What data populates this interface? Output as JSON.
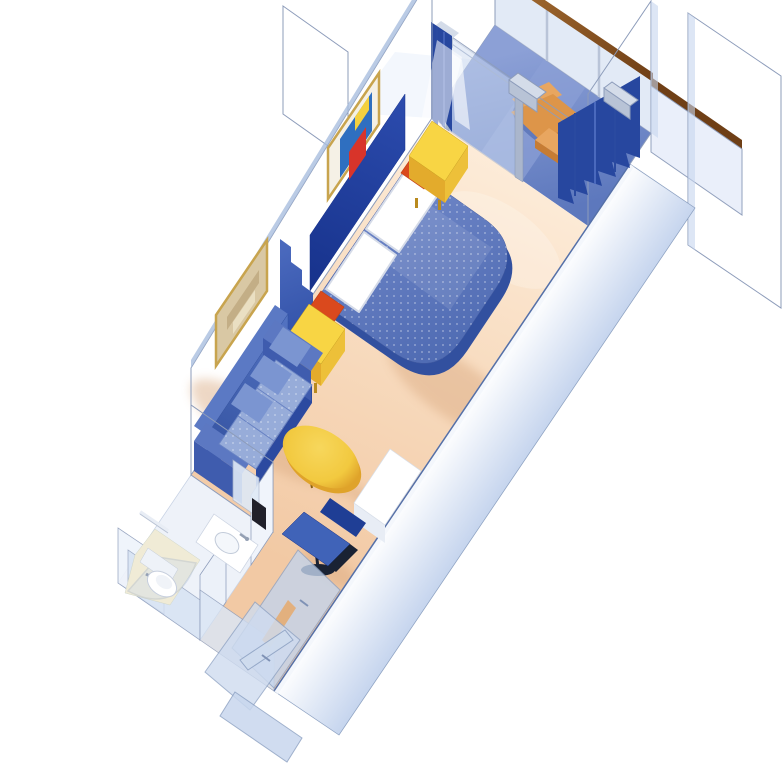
{
  "figure": {
    "kind": "isometric-cutaway-floor-plan",
    "subject": "cruise-ship-stateroom-with-private-balcony",
    "background": "#ffffff"
  },
  "palette": {
    "white": "#ffffff",
    "floor_light": "#fdecd9",
    "floor": "#f8dcc0",
    "floor_deep": "#f2c9a4",
    "floor_shadow": "#d9a87f",
    "bath_floor": "#eef2f9",
    "balcony_floor": "#5d78bd",
    "balcony_light": "#8ca0d6",
    "wall_light": "#e9effa",
    "wall_mid": "#c6d5ee",
    "wall_deep": "#a9bede",
    "edge": "#8d9cba",
    "edge_soft": "#aab6cc",
    "edge_dark": "#5570a8",
    "glass": "#ccdaf0",
    "wood": "#6f3f16",
    "wood_light": "#a86f33",
    "bed_hi": "#7289c9",
    "bed_mid": "#4e6ab2",
    "bed_dark": "#32509f",
    "headboard_hi": "#2c4cae",
    "headboard": "#16318a",
    "pillow": "#ffffff",
    "pillow_shade": "#d5dbe8",
    "nightstand": "#f8d544",
    "nightstand_side": "#e3ab2c",
    "nightstand_leg": "#b98a1e",
    "cushion_hi": "#f47f48",
    "cushion": "#da491d",
    "sofa_back_hi": "#5272c1",
    "sofa_back": "#33519f",
    "sofa_arm": "#5c78c2",
    "sofa_arm_front": "#3f5cae",
    "sofa_seat": "#97acd9",
    "sofa_dark": "#2c4aa0",
    "back_cushion": "#7b95d1",
    "table_hi": "#f7d75c",
    "table_top": "#f2c93f",
    "table_side": "#dfa32a",
    "table_leg": "#8a6010",
    "desk": "#ffffff",
    "desk_side": "#e8edf5",
    "desk_left": "#f2f5fa",
    "chair_seat": "#4063b8",
    "chair_back": "#1f3e95",
    "chair_dark": "#1a2233",
    "curtain_hi": "#4a69bd",
    "curtain": "#27479f",
    "curtain_line": "#2a4aa0",
    "frame_gold": "#c8a44e",
    "art_mat": "#f5f1e6",
    "art1_blue": "#2f6fc0",
    "art1_red": "#d8342a",
    "art1_yellow": "#f4d03f",
    "art2_beige": "#d9c8a4",
    "art2_dark": "#c3ae86",
    "art2_light": "#eadfc2",
    "tan_chair": "#e8a660",
    "tan_seat": "#dd9549",
    "tan_dark": "#c67c34",
    "shower_floor": "#f0ebd6",
    "chrome": "#94a0b4",
    "post": "#aab6cc",
    "cap_front": "#b8c3d6",
    "cap_top": "#d4dce9",
    "towel_dark": "#20202a",
    "fixture_line": "#c6cedd",
    "closet_panel": "#c3d4ec",
    "closet_panel2": "#cfdcf0",
    "closet_edge": "#8fa3c4",
    "wedge_tan": "#e2b07e",
    "line_navy": "#3a58a8"
  },
  "scene": {
    "areas": [
      {
        "name": "balcony",
        "items": [
          "lounge-chair",
          "side-table",
          "glass-balustrade",
          "wood-top-rail",
          "balcony-divider-walls"
        ]
      },
      {
        "name": "sleeping-area",
        "items": [
          "double-bed",
          "two-pillows",
          "headboard-panel",
          "accent-cushion-left",
          "accent-cushion-right",
          "nightstand-left",
          "nightstand-right",
          "abstract-wall-art",
          "pleated-room-divider",
          "sliding-glass-door",
          "window-curtains"
        ]
      },
      {
        "name": "sitting-area",
        "items": [
          "three-seat-sofa",
          "oval-coffee-table",
          "framed-wall-art",
          "vanity-desk",
          "desk-chair"
        ]
      },
      {
        "name": "bathroom",
        "items": [
          "vanity-sink",
          "mirror",
          "toilet",
          "corner-shower",
          "towel-bar",
          "towel-rack"
        ]
      },
      {
        "name": "entry",
        "items": [
          "closet-doors",
          "entry-door"
        ]
      }
    ]
  }
}
